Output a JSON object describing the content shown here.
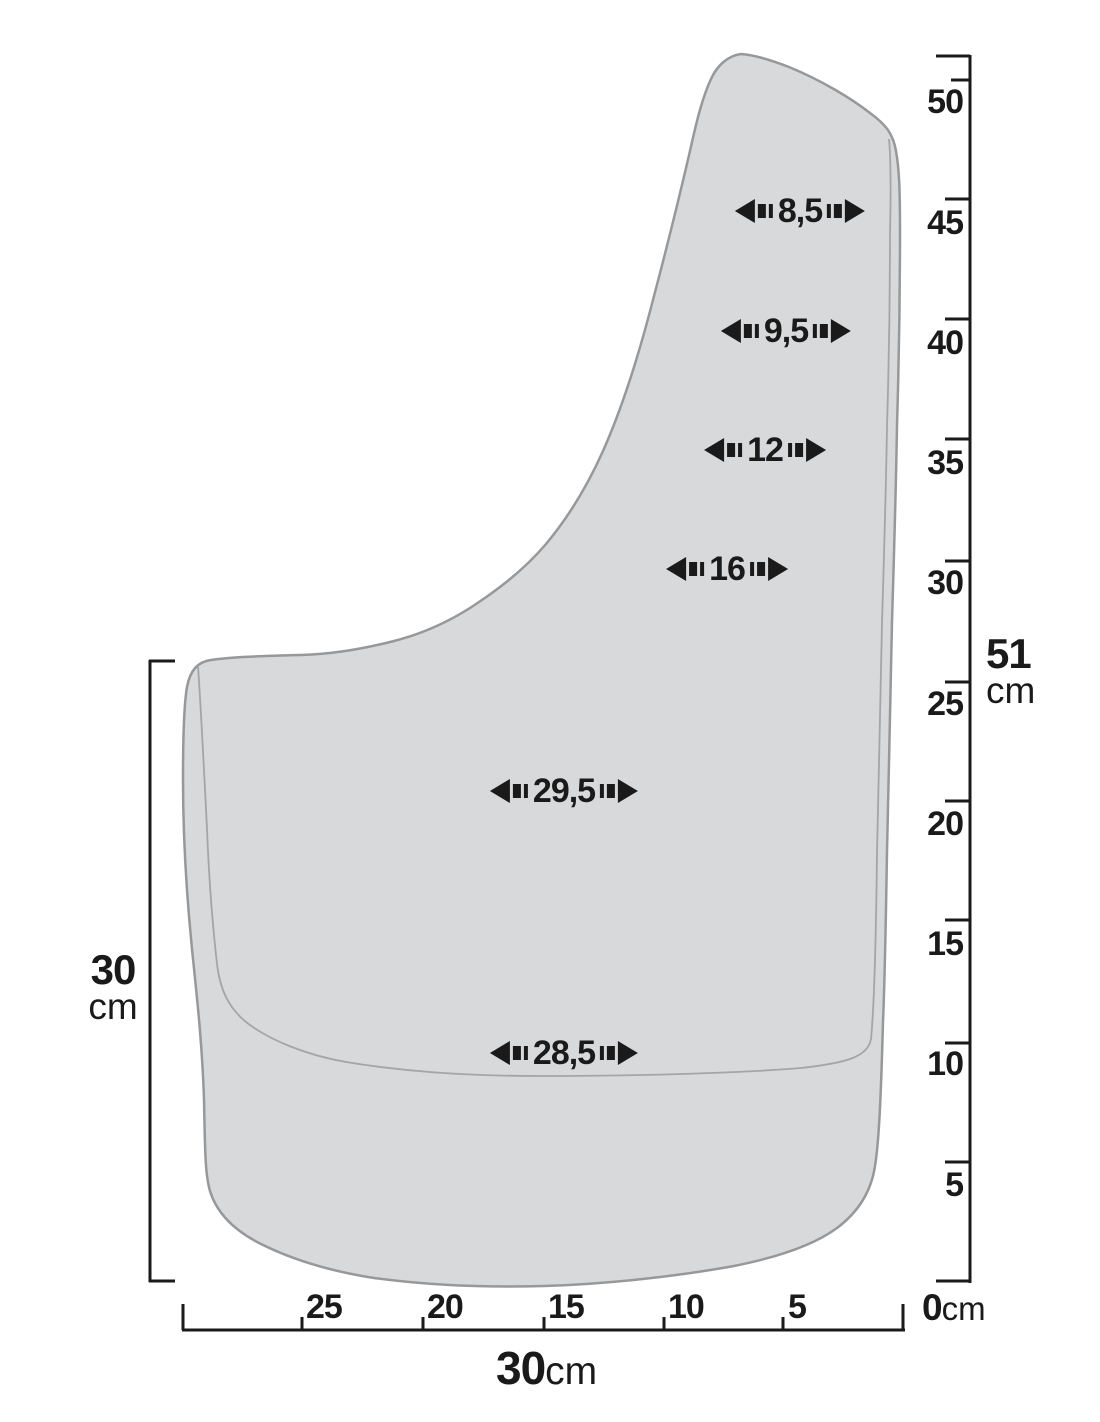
{
  "colors": {
    "background": "#ffffff",
    "ink": "#1a1a1a",
    "flap_fill": "#d8d9da",
    "flap_outline": "#97989a",
    "flap_inner_line": "#a4a5a7"
  },
  "flap_widths_cm": [
    {
      "label": "8,5"
    },
    {
      "label": "9,5"
    },
    {
      "label": "12"
    },
    {
      "label": "16"
    },
    {
      "label": "29,5"
    },
    {
      "label": "28,5"
    }
  ],
  "right_ruler": {
    "tick_labels": [
      "50",
      "45",
      "40",
      "35",
      "30",
      "25",
      "20",
      "15",
      "10",
      "5"
    ],
    "total_height": {
      "value": "51",
      "unit": "cm"
    },
    "origin": {
      "value": "0",
      "unit": "cm"
    }
  },
  "bottom_ruler": {
    "tick_labels": [
      "25",
      "20",
      "15",
      "10",
      "5"
    ],
    "total_width": {
      "value": "30",
      "unit": "cm"
    }
  },
  "left_dimension": {
    "value": "30",
    "unit": "cm"
  }
}
